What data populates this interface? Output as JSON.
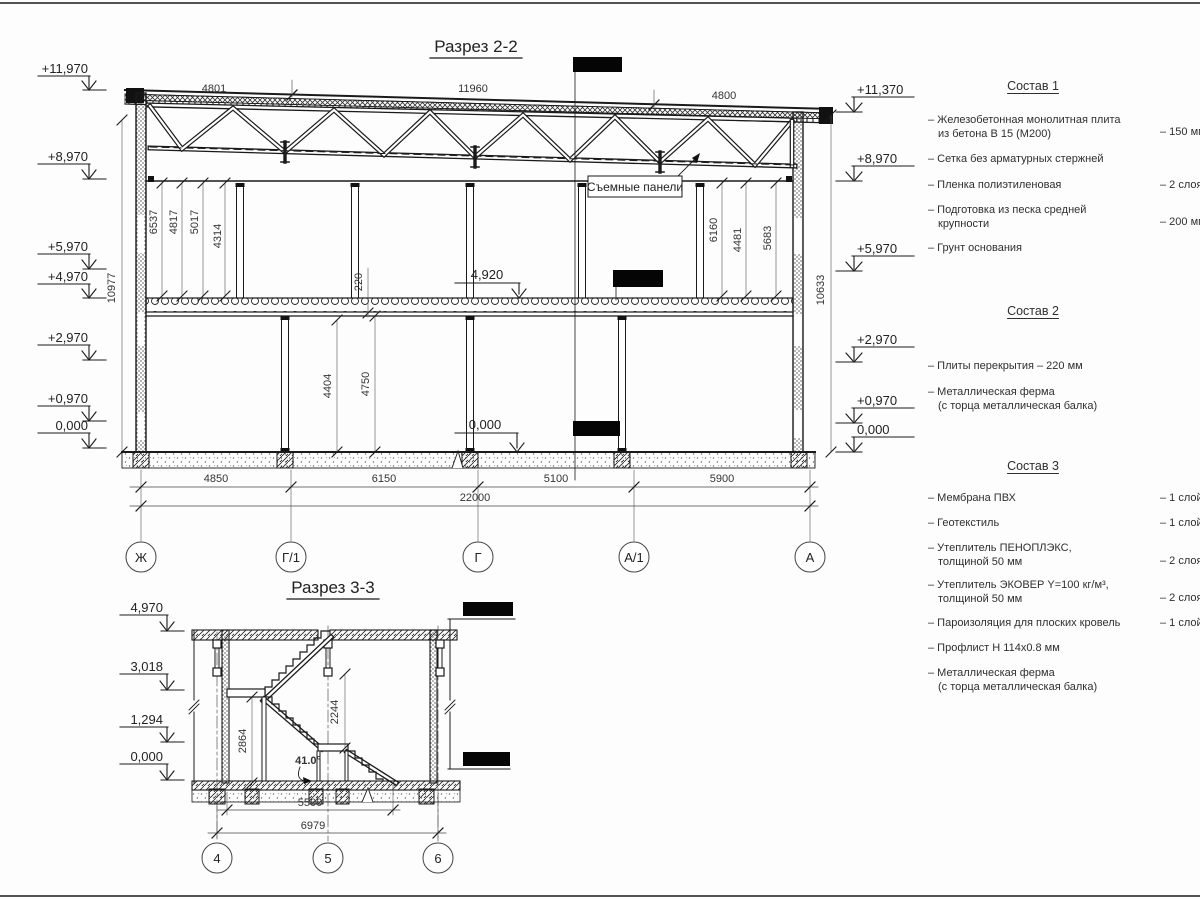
{
  "section22": {
    "title": "Разрез 2-2",
    "callout": "Съемные панели",
    "top_dims": [
      "4801",
      "11960",
      "4800"
    ],
    "elev_left": [
      "+11,970",
      "+8,970",
      "+5,970",
      "+4,970",
      "+2,970",
      "+0,970",
      "0,000"
    ],
    "elev_right": [
      "+11,370",
      "+8,970",
      "+5,970",
      "+2,970",
      "+0,970",
      "0,000"
    ],
    "elev_inner_floor": "4,920",
    "elev_inner_ground": "0,000",
    "upper_dims_left": [
      "6537",
      "4817",
      "5017",
      "4314"
    ],
    "upper_dims_right": [
      "6160",
      "4481",
      "5683"
    ],
    "slab_dim": "220",
    "lower_dims": [
      "4404",
      "4750"
    ],
    "height_left": "10977",
    "height_right": "10633",
    "bottom_dims": [
      "4850",
      "6150",
      "5100",
      "5900"
    ],
    "total_dim": "22000",
    "axes": [
      "Ж",
      "Г/1",
      "Г",
      "А/1",
      "А"
    ]
  },
  "section33": {
    "title": "Разрез 3-3",
    "elev_left": [
      "4,970",
      "3,018",
      "1,294",
      "0,000"
    ],
    "dim_landing": "2864",
    "dim_mid": "2244",
    "angle": "41.0°",
    "bottom_dims": [
      "5500",
      "6979"
    ],
    "axes": [
      "4",
      "5",
      "6"
    ]
  },
  "materials": {
    "sections": [
      {
        "title": "Состав 1",
        "items": [
          {
            "name": "– Железобетонная  монолитная плита\nиз бетона В 15 (М200)",
            "value": "– 150 мм"
          },
          {
            "name": "– Сетка без арматурных стержней",
            "value": ""
          },
          {
            "name": "– Пленка полиэтиленовая",
            "value": "–  2 слоя"
          },
          {
            "name": "– Подготовка из песка средней\nкрупности",
            "value": "– 200 мм"
          },
          {
            "name": "– Грунт основания",
            "value": ""
          }
        ]
      },
      {
        "title": "Состав 2",
        "items": [
          {
            "name": "– Плиты перекрытия – 220 мм",
            "value": ""
          },
          {
            "name": "– Металлическая ферма\n(с торца металлическая балка)",
            "value": ""
          }
        ]
      },
      {
        "title": "Состав 3",
        "items": [
          {
            "name": "– Мембрана ПВХ",
            "value": "– 1 слой"
          },
          {
            "name": "– Геотекстиль",
            "value": "– 1 слой"
          },
          {
            "name": "– Утеплитель ПЕНОПЛЭКС,\nтолщиной 50 мм",
            "value": "– 2 слоя"
          },
          {
            "name": "– Утеплитель ЭКОВЕР Y=100 кг/м³,\nтолщиной 50 мм",
            "value": "– 2 слоя"
          },
          {
            "name": "– Пароизоляция для плоских кровель",
            "value": "– 1 слой"
          },
          {
            "name": "– Профлист Н 114х0.8 мм",
            "value": ""
          },
          {
            "name": "– Металлическая ферма\n(с торца металлическая балка)",
            "value": ""
          }
        ]
      }
    ]
  }
}
